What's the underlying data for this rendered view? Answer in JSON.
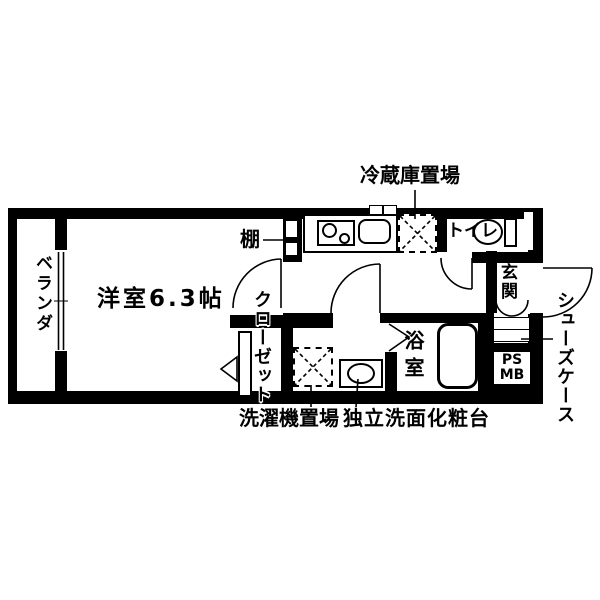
{
  "floorplan": {
    "labels": {
      "refrigerator": "冷蔵庫置場",
      "shelf": "棚",
      "main_room": "洋室6.3帖",
      "closet": "クローゼット",
      "veranda": "ベランダ",
      "toilet": "トイレ",
      "entrance": "玄関",
      "shoe_case": "シューズケース",
      "bathroom": "浴室",
      "pipe_space": "PS",
      "meter_box": "MB",
      "washing_machine": "洗濯機置場",
      "washbasin": "独立洗面化粧台"
    },
    "colors": {
      "wall": "#000000",
      "floor": "#ffffff"
    }
  }
}
